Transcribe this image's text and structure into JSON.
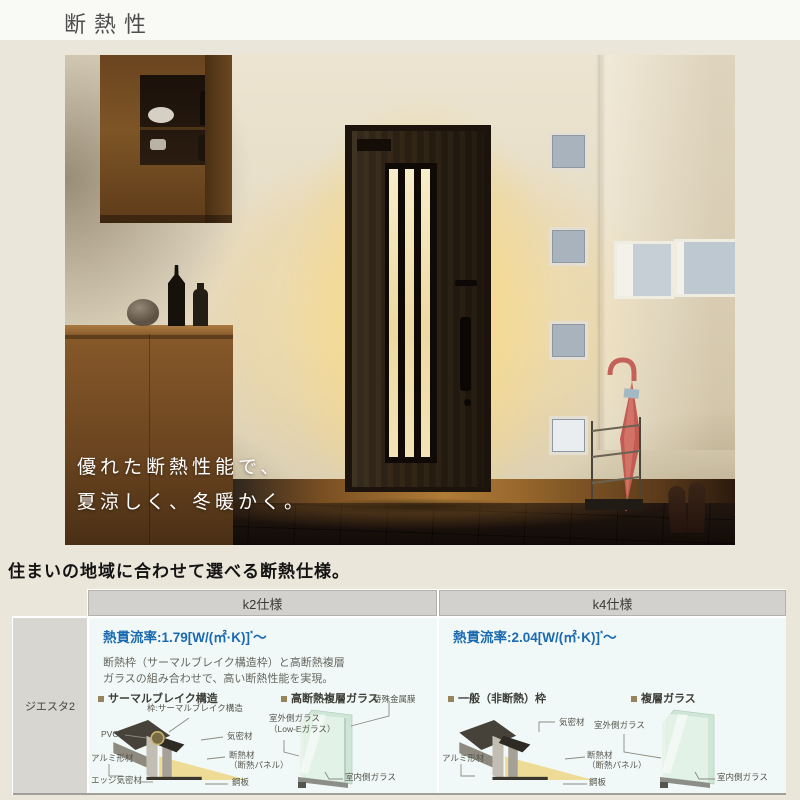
{
  "page": {
    "title": "断熱性",
    "section_heading": "住まいの地域に合わせて選べる断熱仕様。"
  },
  "hero": {
    "caption": [
      "優れた断熱性能で、",
      "夏涼しく、冬暖かく。"
    ]
  },
  "spec_table": {
    "row_label": "ジエスタ2",
    "k2": {
      "header": "k2仕様",
      "u_value": "熱貫流率:1.79[W/(㎡·K)]",
      "u_value_note": "*",
      "u_value_tail": "〜",
      "desc1": "断熱枠（サーマルブレイク構造枠）と高断熱複層",
      "desc2": "ガラスの組み合わせで、高い断熱性能を実現。",
      "frame_title": "サーマルブレイク構造",
      "glass_title": "高断熱複層ガラス",
      "labels": {
        "frame_top": "枠:サーマルブレイク構造",
        "pvc": "PVC",
        "kimitsu": "気密材",
        "alumi": "アルミ形材",
        "dannetsu1": "断熱材",
        "dannetsu2": "（断熱パネル）",
        "edge": "エッジ気密材",
        "kohan": "鋼板",
        "metal_film": "特殊金属膜",
        "outer_glass1": "室外側ガラス",
        "outer_glass2": "（Low-Eガラス）",
        "inner_glass": "室内側ガラス"
      }
    },
    "k4": {
      "header": "k4仕様",
      "u_value": "熱貫流率:2.04[W/(㎡·K)]",
      "u_value_note": "*",
      "u_value_tail": "〜",
      "frame_title": "一般（非断熱）枠",
      "glass_title": "複層ガラス",
      "labels": {
        "kimitsu": "気密材",
        "alumi": "アルミ形材",
        "dannetsu1": "断熱材",
        "dannetsu2": "（断熱パネル）",
        "kohan": "鋼板",
        "outer_glass": "室外側ガラス",
        "inner_glass": "室内側ガラス"
      }
    }
  },
  "colors": {
    "accent_blue": "#1b6ab0",
    "table_header_bg": "#d2d1cd",
    "table_body_bg": "#f1f9f8",
    "insulation_yellow": "#eedc96",
    "glass_green": "#d8ecdf",
    "umbrella_red": "#c25b51"
  }
}
